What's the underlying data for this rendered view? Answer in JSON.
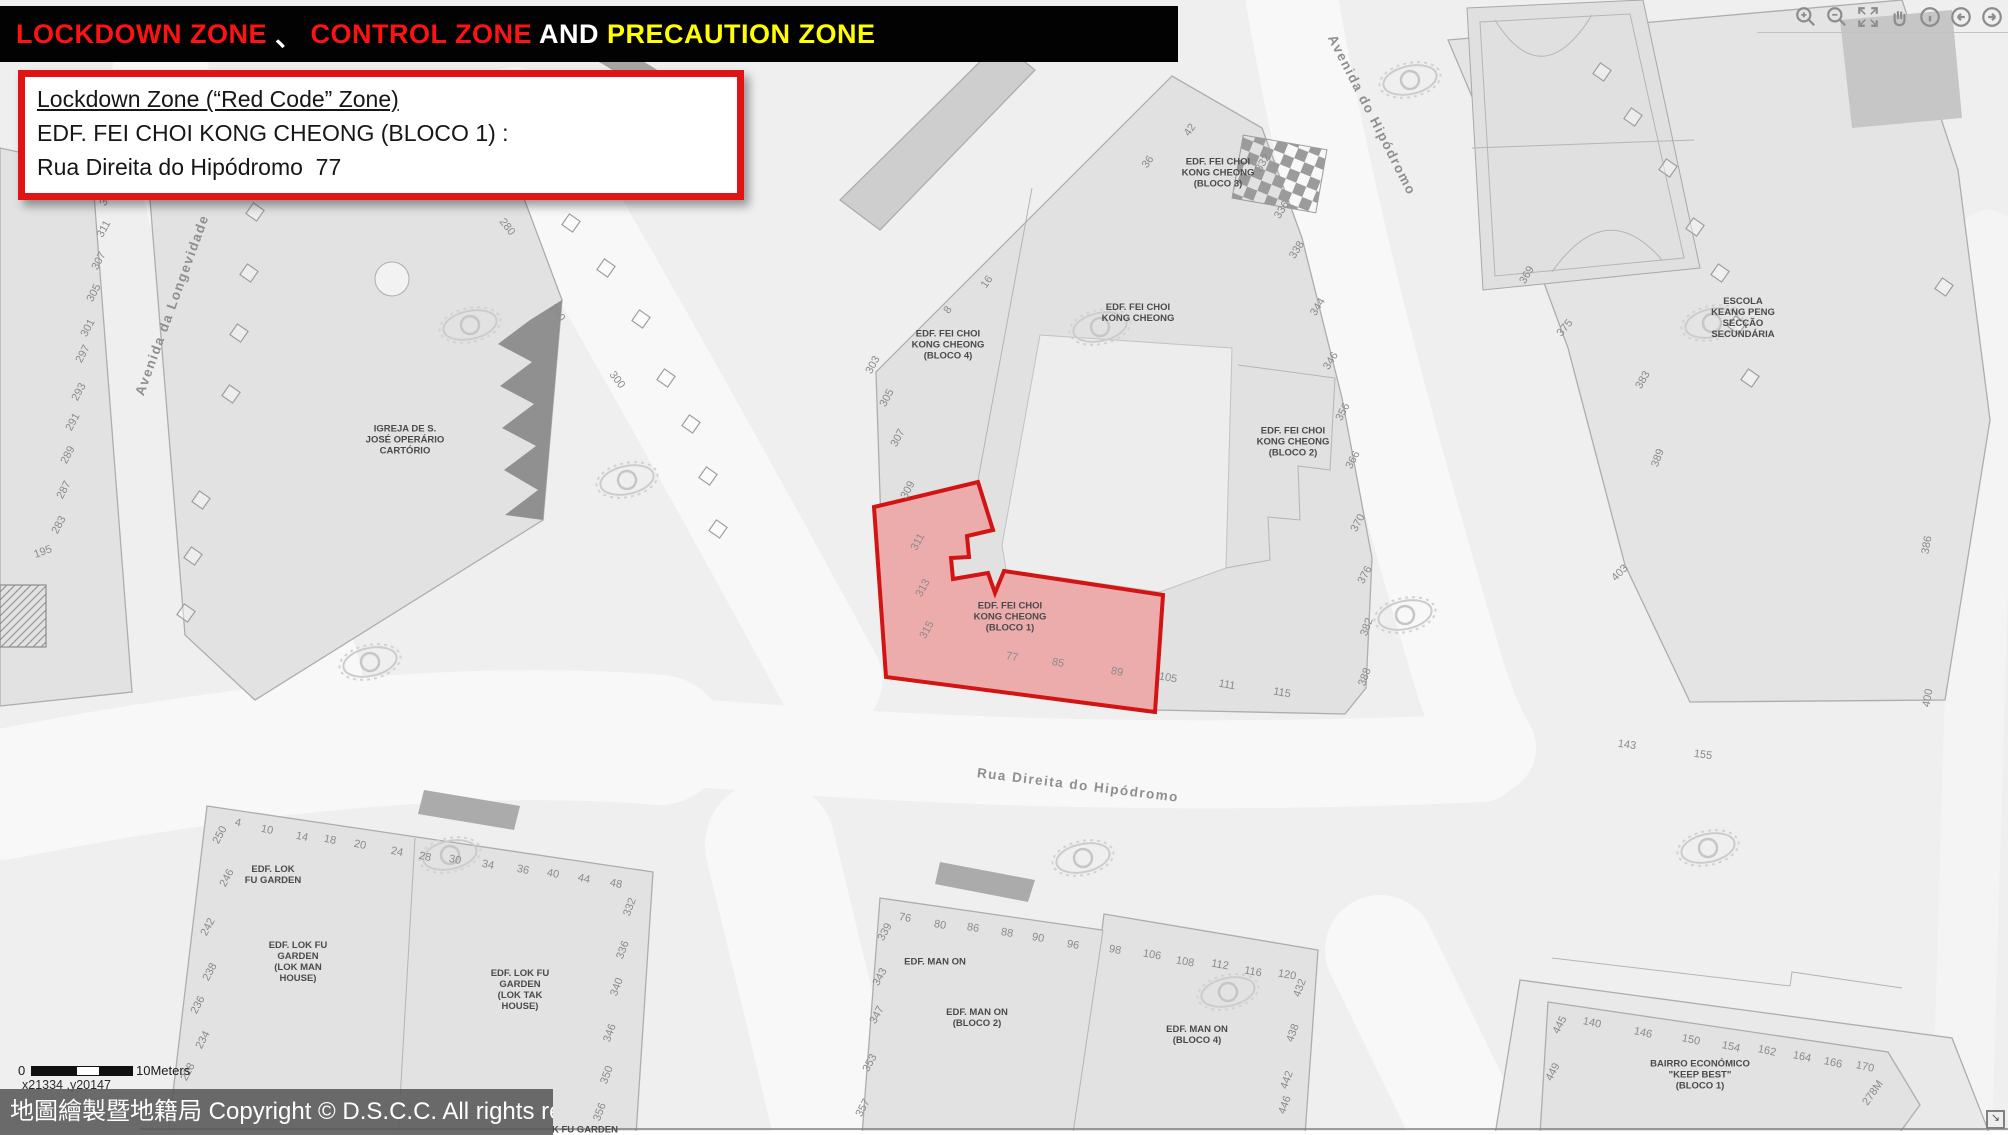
{
  "title_bar": {
    "segments": [
      {
        "text": "LOCKDOWN ZONE ",
        "color": "#ff1212"
      },
      {
        "text": "、 ",
        "color": "#ffffff"
      },
      {
        "text": "CONTROL ZONE",
        "color": "#ff1212"
      },
      {
        "text": " AND ",
        "color": "#ffffff"
      },
      {
        "text": "PRECAUTION ZONE",
        "color": "#ffff00"
      }
    ]
  },
  "info_box": {
    "line1": "Lockdown Zone (“Red Code” Zone)",
    "line2": "EDF. FEI CHOI KONG CHEONG (BLOCO 1) :",
    "line3": "Rua Direita do Hipódromo  77"
  },
  "toolbar": {
    "icons": [
      "zoom-in",
      "zoom-out",
      "full-extent",
      "pan",
      "identify",
      "previous-extent",
      "next-extent"
    ]
  },
  "scale_bar": {
    "zero": "0",
    "label": "10Meters"
  },
  "coords_readout": "x21334 ,y20147",
  "copyright": {
    "text": "地圖繪製暨地籍局 Copyright © D.S.C.C. All rights reserved"
  },
  "corner_button": {
    "glyph": "↘"
  },
  "zone": {
    "name": "Lockdown Zone (Red Code Zone)",
    "building": "EDF. FEI CHOI KONG CHEONG (BLOCO 1)",
    "address": "Rua Direita do Hipódromo 77",
    "fill": "#ecacac",
    "stroke": "#d21414"
  },
  "map": {
    "colors": {
      "street": "#f7f7f7",
      "block": "#e2e2e2",
      "outline": "#adadad",
      "accent": "#9e9e9e",
      "background": "#efefef"
    },
    "street_labels": [
      {
        "t": "Avenida da Longevidade",
        "x": 172,
        "y": 305,
        "r": -70
      },
      {
        "t": "Avenida do Hipódromo",
        "x": 1372,
        "y": 115,
        "r": 63
      },
      {
        "t": "Rua Direita do Hipódromo",
        "x": 1078,
        "y": 785,
        "r": 7
      }
    ],
    "building_labels": [
      {
        "lines": [
          "IGREJA DE S.",
          "JOSÉ OPERÁRIO",
          "CARTÓRIO"
        ],
        "x": 405,
        "y": 440
      },
      {
        "lines": [
          "EDF. FEI CHOI",
          "KONG CHEONG",
          "(BLOCO 3)"
        ],
        "x": 1218,
        "y": 173
      },
      {
        "lines": [
          "EDF. FEI CHOI",
          "KONG CHEONG"
        ],
        "x": 1138,
        "y": 313
      },
      {
        "lines": [
          "EDF. FEI CHOI",
          "KONG CHEONG",
          "(BLOCO 4)"
        ],
        "x": 948,
        "y": 345
      },
      {
        "lines": [
          "EDF. FEI CHOI",
          "KONG CHEONG",
          "(BLOCO 2)"
        ],
        "x": 1293,
        "y": 442
      },
      {
        "lines": [
          "EDF. FEI CHOI",
          "KONG CHEONG",
          "(BLOCO 1)"
        ],
        "x": 1010,
        "y": 617
      },
      {
        "lines": [
          "ESCOLA",
          "KEANG PENG",
          "SECÇÃO",
          "SECUNDÁRIA"
        ],
        "x": 1743,
        "y": 318
      },
      {
        "lines": [
          "EDF. LOK",
          "FU GARDEN"
        ],
        "x": 273,
        "y": 875
      },
      {
        "lines": [
          "EDF. LOK FU",
          "GARDEN",
          "(LOK MAN",
          "HOUSE)"
        ],
        "x": 298,
        "y": 962
      },
      {
        "lines": [
          "EDF. LOK FU",
          "GARDEN",
          "(LOK TAK",
          "HOUSE)"
        ],
        "x": 520,
        "y": 990
      },
      {
        "lines": [
          "EDF. MAN ON"
        ],
        "x": 935,
        "y": 962
      },
      {
        "lines": [
          "EDF. MAN ON",
          "(BLOCO 2)"
        ],
        "x": 977,
        "y": 1018
      },
      {
        "lines": [
          "EDF. MAN ON",
          "(BLOCO 4)"
        ],
        "x": 1197,
        "y": 1035
      },
      {
        "lines": [
          "BAIRRO ECONÓMICO",
          "\"KEEP BEST\"",
          "(BLOCO 1)"
        ],
        "x": 1700,
        "y": 1075
      },
      {
        "lines": [
          "K FU GARDEN"
        ],
        "x": 585,
        "y": 1130
      }
    ],
    "numbers": [
      [
        "315",
        107,
        197,
        -62
      ],
      [
        "311",
        104,
        229,
        -62
      ],
      [
        "307",
        99,
        261,
        -62
      ],
      [
        "305",
        94,
        293,
        -62
      ],
      [
        "301",
        88,
        328,
        -62
      ],
      [
        "297",
        83,
        354,
        -62
      ],
      [
        "293",
        79,
        392,
        -62
      ],
      [
        "291",
        73,
        422,
        -62
      ],
      [
        "289",
        68,
        455,
        -62
      ],
      [
        "287",
        64,
        490,
        -62
      ],
      [
        "283",
        59,
        525,
        -62
      ],
      [
        "195",
        43,
        552,
        -20
      ],
      [
        "280",
        507,
        227,
        52
      ],
      [
        "290",
        557,
        313,
        52
      ],
      [
        "300",
        617,
        380,
        52
      ],
      [
        "42",
        1190,
        130,
        -55
      ],
      [
        "36",
        1148,
        162,
        -55
      ],
      [
        "16",
        987,
        282,
        -55
      ],
      [
        "8",
        948,
        310,
        -55
      ],
      [
        "303",
        873,
        365,
        -62
      ],
      [
        "305",
        887,
        398,
        -62
      ],
      [
        "307",
        898,
        438,
        -62
      ],
      [
        "309",
        908,
        490,
        -62
      ],
      [
        "311",
        918,
        542,
        -62
      ],
      [
        "313",
        923,
        588,
        -62
      ],
      [
        "315",
        927,
        630,
        -62
      ],
      [
        "77",
        1012,
        657,
        10
      ],
      [
        "85",
        1058,
        663,
        10
      ],
      [
        "89",
        1117,
        672,
        10
      ],
      [
        "105",
        1168,
        678,
        10
      ],
      [
        "111",
        1227,
        685,
        10
      ],
      [
        "115",
        1282,
        693,
        10
      ],
      [
        "332",
        1263,
        163,
        -58
      ],
      [
        "336",
        1282,
        210,
        -58
      ],
      [
        "338",
        1297,
        250,
        -58
      ],
      [
        "344",
        1318,
        307,
        -58
      ],
      [
        "346",
        1331,
        361,
        -58
      ],
      [
        "356",
        1343,
        412,
        -62
      ],
      [
        "366",
        1353,
        460,
        -62
      ],
      [
        "370",
        1358,
        523,
        -62
      ],
      [
        "376",
        1365,
        575,
        -62
      ],
      [
        "382",
        1367,
        627,
        -70
      ],
      [
        "388",
        1365,
        677,
        -70
      ],
      [
        "369",
        1527,
        275,
        -60
      ],
      [
        "375",
        1565,
        328,
        -50
      ],
      [
        "383",
        1643,
        380,
        -60
      ],
      [
        "389",
        1658,
        458,
        -70
      ],
      [
        "403",
        1620,
        573,
        -45
      ],
      [
        "386",
        1927,
        545,
        -80
      ],
      [
        "400",
        1928,
        698,
        -80
      ],
      [
        "143",
        1627,
        745,
        8
      ],
      [
        "155",
        1703,
        755,
        8
      ],
      [
        "4",
        238,
        823,
        12
      ],
      [
        "10",
        267,
        830,
        12
      ],
      [
        "14",
        302,
        837,
        12
      ],
      [
        "18",
        330,
        840,
        12
      ],
      [
        "20",
        360,
        845,
        12
      ],
      [
        "24",
        397,
        852,
        12
      ],
      [
        "28",
        425,
        857,
        12
      ],
      [
        "30",
        455,
        860,
        12
      ],
      [
        "34",
        488,
        865,
        12
      ],
      [
        "36",
        523,
        870,
        12
      ],
      [
        "40",
        553,
        874,
        12
      ],
      [
        "44",
        584,
        879,
        12
      ],
      [
        "48",
        616,
        884,
        12
      ],
      [
        "250",
        220,
        835,
        -62
      ],
      [
        "246",
        227,
        878,
        -62
      ],
      [
        "242",
        208,
        927,
        -62
      ],
      [
        "238",
        210,
        972,
        -62
      ],
      [
        "236",
        198,
        1005,
        -62
      ],
      [
        "234",
        203,
        1040,
        -62
      ],
      [
        "228",
        188,
        1072,
        -62
      ],
      [
        "332",
        630,
        907,
        -70
      ],
      [
        "336",
        623,
        950,
        -70
      ],
      [
        "340",
        617,
        987,
        -70
      ],
      [
        "346",
        610,
        1033,
        -70
      ],
      [
        "350",
        607,
        1075,
        -70
      ],
      [
        "356",
        600,
        1112,
        -70
      ],
      [
        "76",
        905,
        918,
        10
      ],
      [
        "80",
        940,
        925,
        10
      ],
      [
        "86",
        973,
        928,
        10
      ],
      [
        "88",
        1007,
        933,
        10
      ],
      [
        "90",
        1038,
        938,
        10
      ],
      [
        "96",
        1073,
        945,
        10
      ],
      [
        "98",
        1115,
        950,
        10
      ],
      [
        "106",
        1152,
        955,
        10
      ],
      [
        "108",
        1185,
        962,
        10
      ],
      [
        "112",
        1220,
        965,
        10
      ],
      [
        "116",
        1253,
        972,
        10
      ],
      [
        "120",
        1287,
        975,
        10
      ],
      [
        "339",
        885,
        932,
        -62
      ],
      [
        "343",
        880,
        977,
        -62
      ],
      [
        "347",
        877,
        1015,
        -62
      ],
      [
        "353",
        870,
        1063,
        -62
      ],
      [
        "357",
        863,
        1108,
        -62
      ],
      [
        "432",
        1300,
        988,
        -70
      ],
      [
        "438",
        1293,
        1033,
        -70
      ],
      [
        "442",
        1287,
        1080,
        -70
      ],
      [
        "446",
        1285,
        1105,
        -70
      ],
      [
        "445",
        1560,
        1025,
        -62
      ],
      [
        "449",
        1553,
        1072,
        -62
      ],
      [
        "140",
        1592,
        1023,
        12
      ],
      [
        "146",
        1643,
        1033,
        12
      ],
      [
        "150",
        1691,
        1040,
        12
      ],
      [
        "154",
        1731,
        1047,
        12
      ],
      [
        "162",
        1767,
        1051,
        12
      ],
      [
        "164",
        1802,
        1057,
        12
      ],
      [
        "166",
        1833,
        1063,
        12
      ],
      [
        "170",
        1865,
        1067,
        12
      ],
      [
        "278M",
        1873,
        1093,
        -55
      ]
    ],
    "squares": [
      [
        255,
        212
      ],
      [
        249,
        273
      ],
      [
        239,
        333
      ],
      [
        231,
        394
      ],
      [
        201,
        500
      ],
      [
        193,
        556
      ],
      [
        186,
        613
      ],
      [
        571,
        223
      ],
      [
        606,
        268
      ],
      [
        641,
        319
      ],
      [
        666,
        378
      ],
      [
        691,
        424
      ],
      [
        708,
        476
      ],
      [
        718,
        529
      ],
      [
        1602,
        72
      ],
      [
        1633,
        117
      ],
      [
        1668,
        168
      ],
      [
        1695,
        227
      ],
      [
        1720,
        273
      ],
      [
        1737,
        325
      ],
      [
        1750,
        378
      ],
      [
        1944,
        287
      ]
    ],
    "watermarks": [
      [
        470,
        325
      ],
      [
        627,
        480
      ],
      [
        370,
        662
      ],
      [
        1100,
        327
      ],
      [
        1410,
        80
      ],
      [
        1712,
        323
      ],
      [
        1405,
        615
      ],
      [
        450,
        855
      ],
      [
        1083,
        858
      ],
      [
        1708,
        848
      ],
      [
        1228,
        992
      ]
    ]
  }
}
